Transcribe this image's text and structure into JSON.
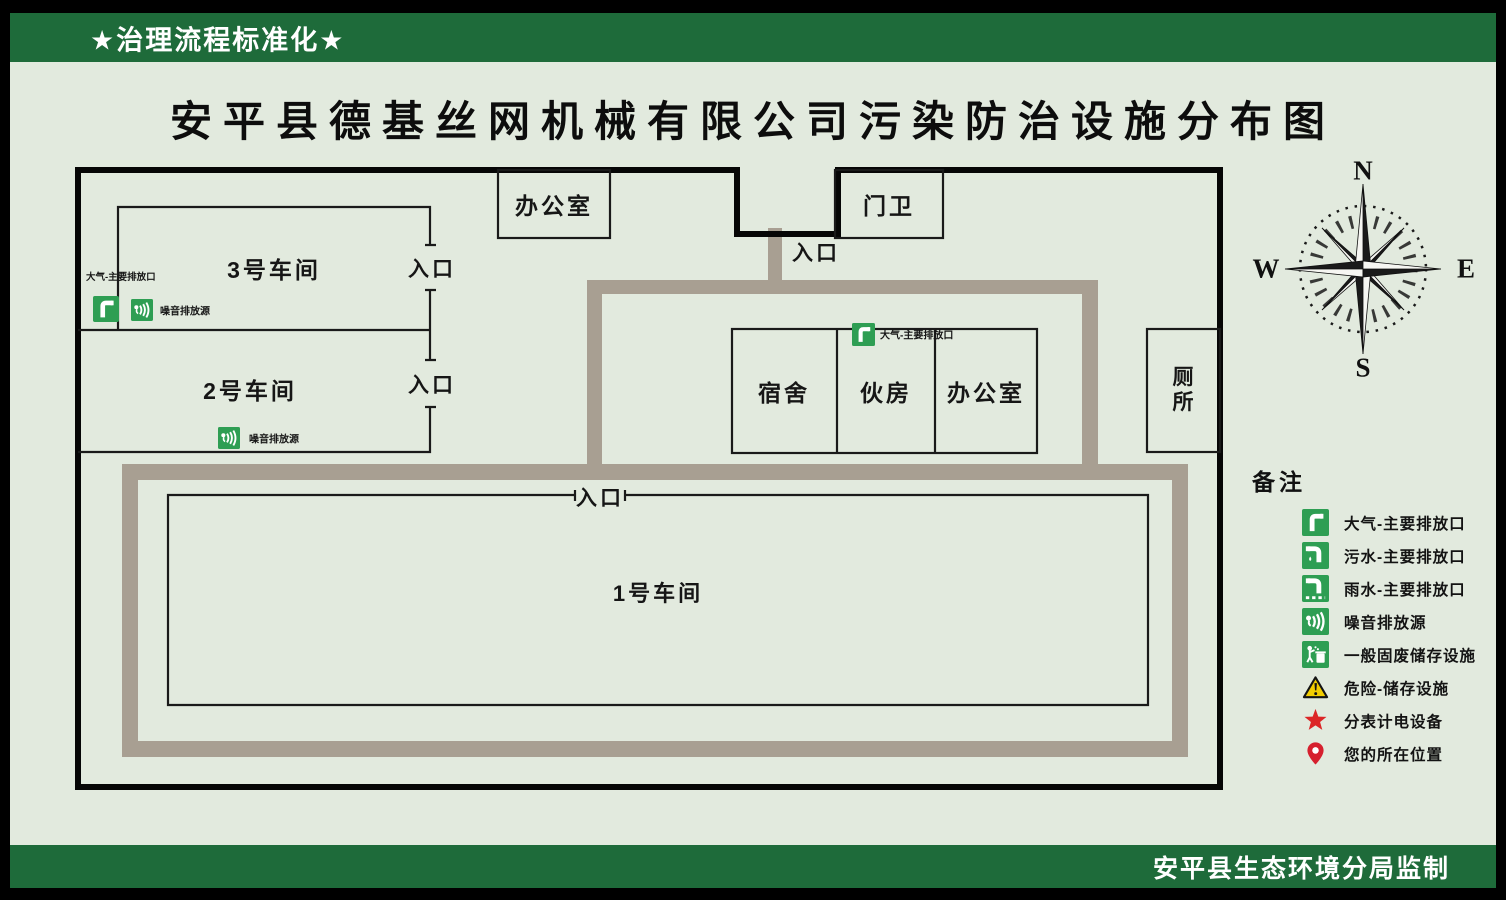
{
  "banner_top": {
    "text": "★治理流程标准化★"
  },
  "title": "安平县德基丝网机械有限公司污染防治设施分布图",
  "map": {
    "buildings": {
      "office_top": "办公室",
      "gatehouse": "门卫",
      "workshop3": "3号车间",
      "workshop2": "2号车间",
      "workshop1": "1号车间",
      "dormitory": "宿舍",
      "kitchen": "伙房",
      "office_mid": "办公室",
      "toilet": "厕所"
    },
    "entrance_label": "入口",
    "annotations": {
      "air_outlet": "大气-主要排放口",
      "noise_source": "噪音排放源"
    }
  },
  "compass": {
    "n": "N",
    "s": "S",
    "e": "E",
    "w": "W"
  },
  "legend": {
    "title": "备注",
    "items": [
      {
        "icon": "air-outlet-icon",
        "label": "大气-主要排放口"
      },
      {
        "icon": "sewage-outlet-icon",
        "label": "污水-主要排放口"
      },
      {
        "icon": "rain-outlet-icon",
        "label": "雨水-主要排放口"
      },
      {
        "icon": "noise-source-icon",
        "label": "噪音排放源"
      },
      {
        "icon": "solid-waste-icon",
        "label": "一般固废储存设施"
      },
      {
        "icon": "hazard-storage-icon",
        "label": "危险-储存设施"
      },
      {
        "icon": "submeter-power-icon",
        "label": "分表计电设备"
      },
      {
        "icon": "your-location-icon",
        "label": "您的所在位置"
      }
    ]
  },
  "banner_bottom": {
    "text": "安平县生态环境分局监制"
  },
  "colors": {
    "banner_green": "#1e6b3a",
    "icon_green": "#2e9e53",
    "road": "#a89f92",
    "bg": "#e2eade"
  }
}
